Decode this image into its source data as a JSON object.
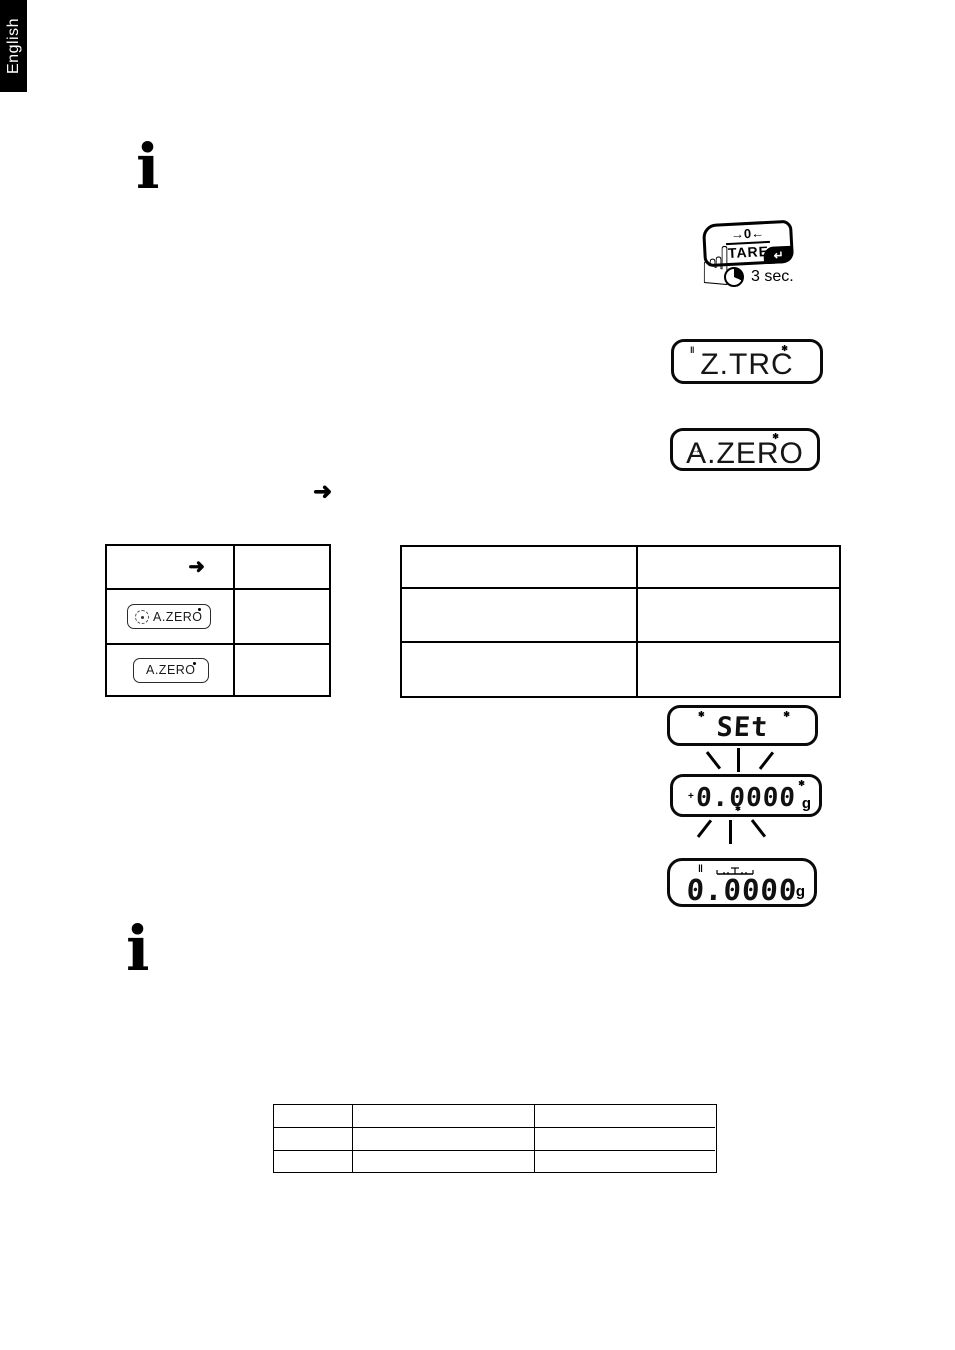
{
  "language_tab": {
    "label": "English"
  },
  "info_icon": {
    "glyph": "i"
  },
  "tare_button": {
    "zero_label": "→0←",
    "tare_label": "TARE",
    "enter_glyph": "↵",
    "hand_glyph": "☝",
    "duration": "3 sec."
  },
  "flow_arrow_glyph": "➜",
  "displays": {
    "ztrc": {
      "text": "Z.TRC",
      "stability_glyph": "‖",
      "star_glyph": "✱"
    },
    "azero": {
      "text": "A.ZERO",
      "arrow_glyph": "→",
      "star_glyph": "✱"
    },
    "set": {
      "text": "SEt",
      "star_left_glyph": "✱",
      "star_right_glyph": "✱"
    },
    "zero_flashing": {
      "value": "0.0000",
      "unit": "g",
      "plus_glyph": "+",
      "star_top_glyph": "✱",
      "star_bottom_glyph": "✱"
    },
    "zero_stable": {
      "value": "0.0000",
      "unit": "g",
      "stability_glyph": "‖"
    }
  },
  "left_table": {
    "rows": [
      {
        "arrow_glyph": "➜"
      },
      {
        "display_text": "A.ZERO"
      },
      {
        "display_text": "A.ZERO"
      }
    ]
  },
  "colors": {
    "ink": "#000000",
    "paper": "#ffffff",
    "tab_bg": "#000000",
    "tab_text": "#ffffff"
  }
}
